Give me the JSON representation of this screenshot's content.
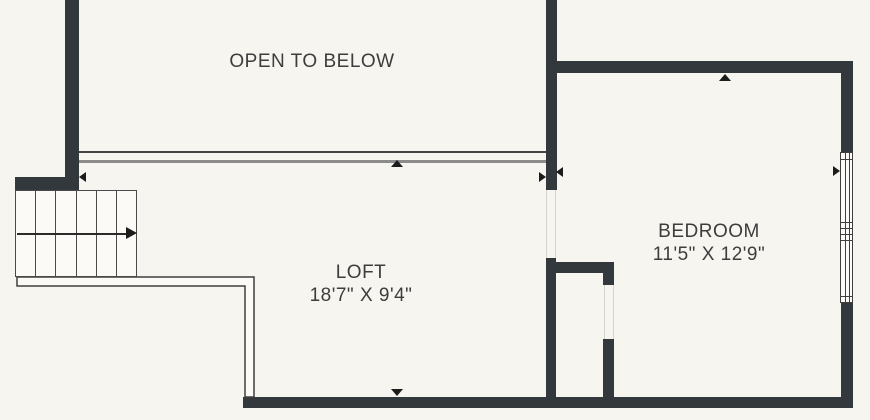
{
  "title": "Loft level floor plan",
  "colors": {
    "background": "#f6f5f0",
    "wall": "#32383b",
    "line_dark": "#3f3f3f",
    "line_gray": "#8c8c8c",
    "line_faint": "#d4d3cc",
    "text": "#3d3d3d",
    "marker": "#1c1c1c",
    "fill": "#fbfaf6"
  },
  "rooms": {
    "open_to_below": {
      "label": "OPEN TO BELOW"
    },
    "loft": {
      "label": "LOFT",
      "dimensions": "18'7\" X 9'4\""
    },
    "bedroom": {
      "label": "BEDROOM",
      "dimensions": "11'5\" X 12'9\""
    }
  },
  "features": {
    "staircase": {
      "treads": 6,
      "direction": "up-to-right"
    },
    "window_panels": 2
  }
}
